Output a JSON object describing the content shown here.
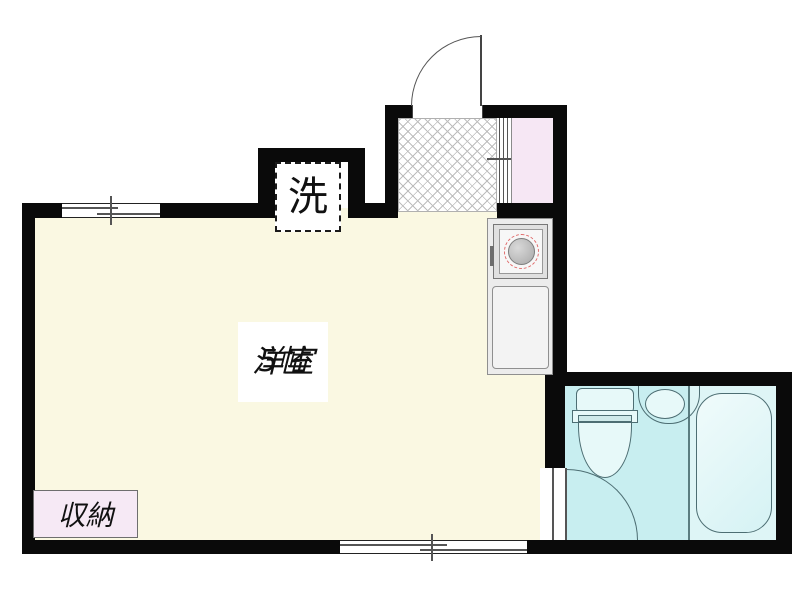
{
  "plan": {
    "title": "apartment-floorplan",
    "labels": {
      "laundry": "洗",
      "room_name": "洋室",
      "room_size": "5帖",
      "closet": "収納"
    },
    "colors": {
      "wall": "#0a0a0a",
      "room_floor": "#faf8e2",
      "kitchen_corridor_floor": "#f6e7f4",
      "closet_fill": "#f6e9f5",
      "bathroom_floor": "#c8eef0",
      "bathtub_zone_floor": "#def5f6",
      "fixture_fill": "#e7f9f9",
      "fixture_outline": "#4d6e73",
      "burner_ring": "#e06a6a",
      "crosshatch_line": "#bdbdbd"
    }
  }
}
